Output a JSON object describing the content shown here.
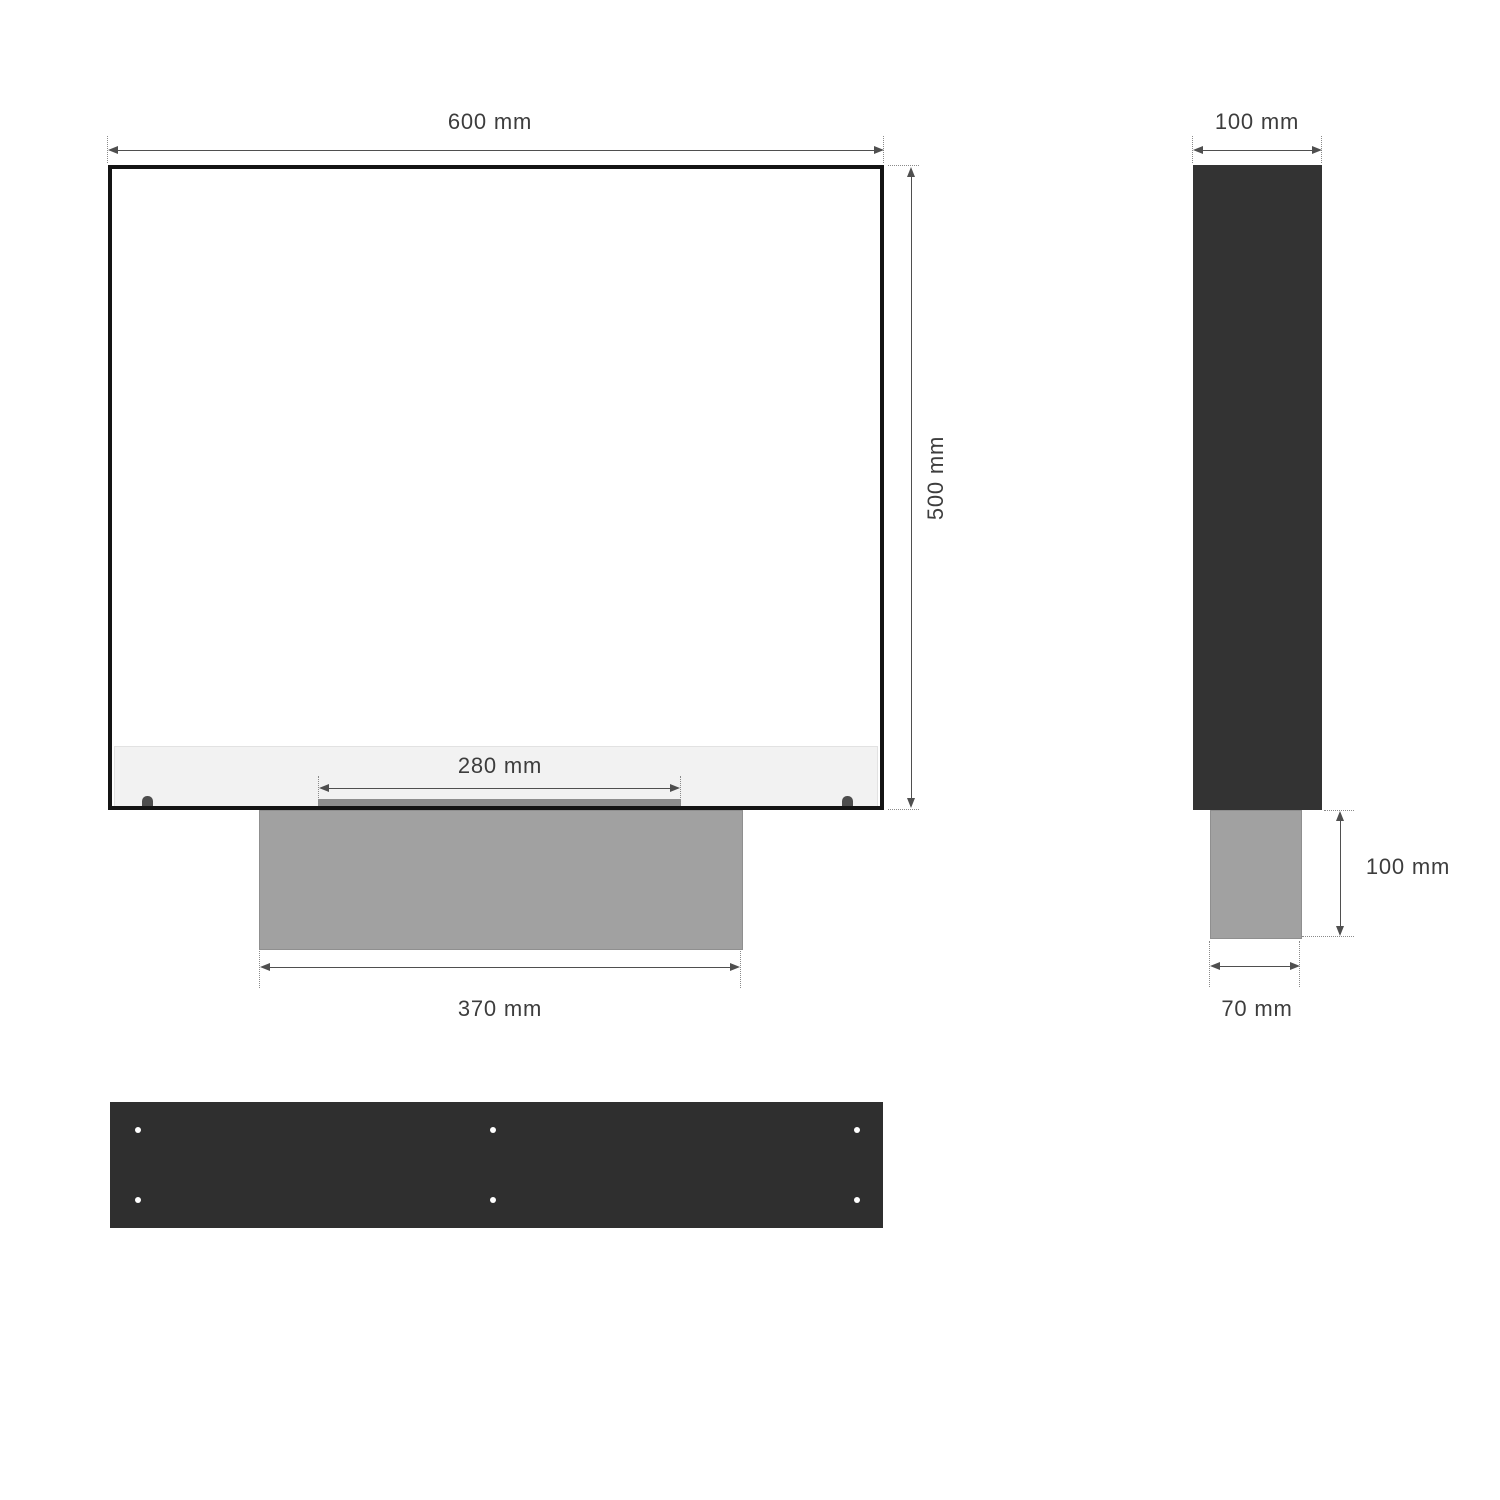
{
  "diagram": {
    "type": "technical-dimension-drawing",
    "front_view": {
      "overall_width": "600 mm",
      "overall_height": "500 mm",
      "burner_width": "280 mm",
      "base_width": "370 mm"
    },
    "side_view": {
      "depth": "100 mm",
      "foot_height": "100 mm",
      "foot_depth": "70 mm"
    },
    "bottom_view": {
      "hole_count": 6
    },
    "colors": {
      "outline_black": "#141414",
      "body_dark": "#333333",
      "panel_dark": "#2f2f2f",
      "base_gray": "#a1a1a1",
      "strip_gray": "#8e8e8e",
      "band_light": "#f2f2f2",
      "tab_dark": "#4d4d4d",
      "dim_line": "#4f4f4f",
      "label_text": "#3d3d3d",
      "hole_white": "#ffffff"
    }
  }
}
